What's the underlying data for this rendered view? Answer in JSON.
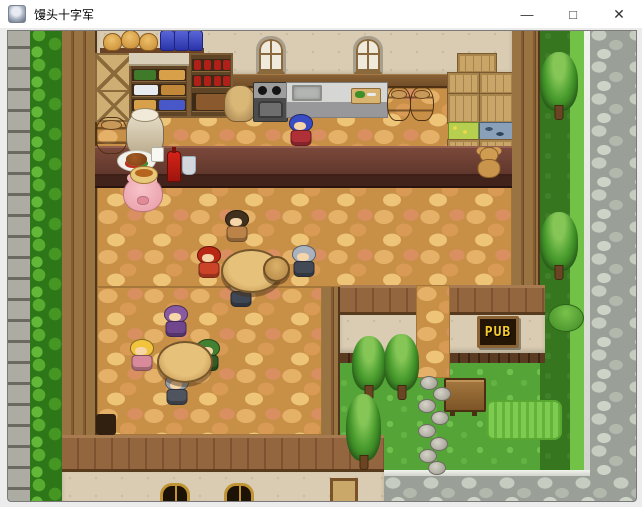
{
  "window": {
    "title": "馒头十字军",
    "controls": {
      "minimize": "—",
      "maximize": "□",
      "close": "✕"
    }
  },
  "scene": {
    "pub_sign": "PUB",
    "colors": {
      "floor": "#c88f47",
      "road": "#9aa098",
      "grass": "#55a438",
      "counter": "#5f352b",
      "sign_text": "#f5cb2e"
    },
    "entities": [
      {
        "id": "npc-bartender",
        "label": "blue-haired bartender",
        "type": "npc",
        "x": 287,
        "y": 114,
        "w": 28,
        "h": 34,
        "c1": "#3a4cc4",
        "c2": "#b03038",
        "interactable": true
      },
      {
        "id": "npc-pig",
        "label": "pink pig",
        "type": "pig",
        "x": 123,
        "y": 176,
        "w": 38,
        "h": 34,
        "interactable": true
      },
      {
        "id": "npc-muscle-patron",
        "label": "dark-haired brawler",
        "type": "npc",
        "x": 222,
        "y": 210,
        "w": 30,
        "h": 36,
        "c1": "#41301e",
        "c2": "#bc8348",
        "interactable": true
      },
      {
        "id": "npc-red-knight",
        "label": "red armored knight",
        "type": "npc",
        "x": 194,
        "y": 246,
        "w": 29,
        "h": 34,
        "c1": "#b82814",
        "c2": "#cc4428",
        "interactable": true
      },
      {
        "id": "npc-gray-knight",
        "label": "silver helmet knight",
        "type": "npc",
        "x": 289,
        "y": 245,
        "w": 30,
        "h": 36,
        "c1": "#aab2bd",
        "c2": "#434a56",
        "interactable": true
      },
      {
        "id": "npc-bald-patron",
        "label": "bald patron",
        "type": "npc",
        "x": 228,
        "y": 275,
        "w": 26,
        "h": 34,
        "c1": "#f0cda0",
        "c2": "#3f4654",
        "interactable": true
      },
      {
        "id": "npc-purple-wizard",
        "label": "purple hooded wizard",
        "type": "npc",
        "x": 160,
        "y": 305,
        "w": 31,
        "h": 36,
        "c1": "#8a5aa0",
        "c2": "#70468c",
        "interactable": true
      },
      {
        "id": "npc-blonde-girl",
        "label": "blonde girl",
        "type": "npc",
        "x": 128,
        "y": 339,
        "w": 28,
        "h": 34,
        "c1": "#f2c33c",
        "c2": "#d8899a",
        "interactable": true
      },
      {
        "id": "npc-green-hat",
        "label": "green hat adventurer",
        "type": "npc",
        "x": 194,
        "y": 339,
        "w": 28,
        "h": 34,
        "c1": "#428032",
        "c2": "#315c28",
        "interactable": true
      },
      {
        "id": "npc-gray-helm",
        "label": "gray helmet soldier",
        "type": "npc",
        "x": 163,
        "y": 373,
        "w": 28,
        "h": 35,
        "c1": "#9aa1a9",
        "c2": "#4f545e",
        "interactable": true
      },
      {
        "id": "round-table-1",
        "label": "round wooden table",
        "type": "table",
        "x": 221,
        "y": 249,
        "w": 57,
        "h": 40,
        "interactable": false
      },
      {
        "id": "stool-1",
        "label": "wooden stool",
        "type": "stool",
        "x": 263,
        "y": 256,
        "w": 23,
        "h": 22,
        "interactable": false
      },
      {
        "id": "round-table-2",
        "label": "round wooden table",
        "type": "table",
        "x": 157,
        "y": 341,
        "w": 52,
        "h": 38,
        "interactable": false
      },
      {
        "id": "barrel-left",
        "type": "barrel",
        "x": 95,
        "y": 117,
        "w": 31,
        "h": 35,
        "interactable": false
      },
      {
        "id": "ceramic-pot",
        "type": "pot",
        "x": 126,
        "y": 111,
        "w": 36,
        "h": 44,
        "interactable": false
      },
      {
        "id": "barrel-kitchen-1",
        "type": "barrel",
        "x": 387,
        "y": 87,
        "w": 22,
        "h": 32,
        "interactable": false
      },
      {
        "id": "barrel-kitchen-2",
        "type": "barrel",
        "x": 410,
        "y": 87,
        "w": 22,
        "h": 32,
        "interactable": false
      },
      {
        "id": "teddy-bear",
        "type": "teddy",
        "x": 475,
        "y": 146,
        "w": 28,
        "h": 34,
        "interactable": false
      },
      {
        "id": "plate-roast",
        "type": "plate",
        "x": 117,
        "y": 150,
        "w": 37,
        "h": 20,
        "interactable": false
      },
      {
        "id": "bowl-curry",
        "type": "bowl",
        "x": 130,
        "y": 166,
        "w": 26,
        "h": 16,
        "interactable": false
      },
      {
        "id": "white-mug",
        "type": "mug",
        "x": 151,
        "y": 147,
        "w": 11,
        "h": 13,
        "interactable": false
      },
      {
        "id": "red-bottle",
        "type": "bottle",
        "x": 167,
        "y": 151,
        "w": 12,
        "h": 29,
        "interactable": false
      },
      {
        "id": "wine-glass",
        "type": "glass",
        "x": 182,
        "y": 156,
        "w": 12,
        "h": 17,
        "interactable": false
      },
      {
        "id": "tree-roadside-1",
        "type": "tree",
        "x": 540,
        "y": 52,
        "w": 38,
        "h": 68,
        "interactable": false
      },
      {
        "id": "tree-roadside-2",
        "type": "tree",
        "x": 540,
        "y": 212,
        "w": 38,
        "h": 68,
        "interactable": false
      },
      {
        "id": "bush-roadside",
        "type": "bush",
        "x": 548,
        "y": 304,
        "w": 34,
        "h": 26,
        "interactable": false
      },
      {
        "id": "tree-yard-1",
        "type": "tree",
        "x": 352,
        "y": 336,
        "w": 34,
        "h": 64,
        "interactable": false
      },
      {
        "id": "tree-yard-2",
        "type": "tree",
        "x": 384,
        "y": 334,
        "w": 35,
        "h": 66,
        "interactable": false
      },
      {
        "id": "tree-yard-3",
        "type": "tree",
        "x": 346,
        "y": 394,
        "w": 35,
        "h": 76,
        "interactable": false
      },
      {
        "id": "wooden-bench",
        "type": "bench",
        "x": 444,
        "y": 378,
        "w": 38,
        "h": 30,
        "interactable": false
      },
      {
        "id": "step-stone-1",
        "type": "stone",
        "x": 420,
        "y": 376,
        "w": 16,
        "h": 12,
        "interactable": false
      },
      {
        "id": "step-stone-2",
        "type": "stone",
        "x": 433,
        "y": 387,
        "w": 16,
        "h": 12,
        "interactable": false
      },
      {
        "id": "step-stone-3",
        "type": "stone",
        "x": 418,
        "y": 399,
        "w": 16,
        "h": 12,
        "interactable": false
      },
      {
        "id": "step-stone-4",
        "type": "stone",
        "x": 431,
        "y": 411,
        "w": 16,
        "h": 12,
        "interactable": false
      },
      {
        "id": "step-stone-5",
        "type": "stone",
        "x": 418,
        "y": 424,
        "w": 16,
        "h": 12,
        "interactable": false
      },
      {
        "id": "step-stone-6",
        "type": "stone",
        "x": 430,
        "y": 437,
        "w": 16,
        "h": 12,
        "interactable": false
      },
      {
        "id": "step-stone-7",
        "type": "stone",
        "x": 419,
        "y": 449,
        "w": 16,
        "h": 12,
        "interactable": false
      },
      {
        "id": "step-stone-8",
        "type": "stone",
        "x": 428,
        "y": 461,
        "w": 16,
        "h": 12,
        "interactable": false
      }
    ]
  }
}
